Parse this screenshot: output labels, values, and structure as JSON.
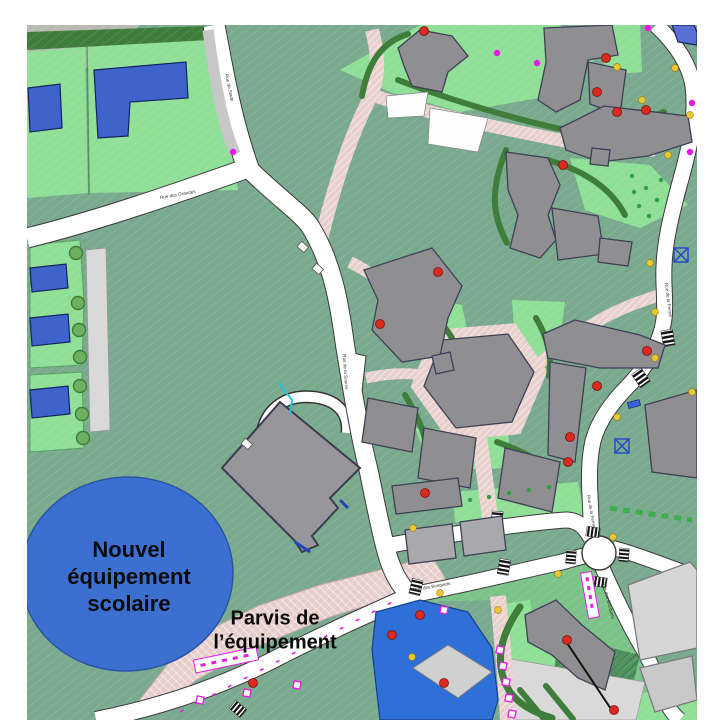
{
  "labels": {
    "school": "Nouvel\néquipement\nscolaire",
    "parvis": "Parvis de\nl’équipement"
  },
  "road_labels": [
    {
      "name": "Rue des Grandes",
      "x": 178,
      "y": 196,
      "rot": -10
    },
    {
      "name": "Rue du Stade",
      "x": 228,
      "y": 88,
      "rot": 78
    },
    {
      "name": "Rue de la Source",
      "x": 344,
      "y": 372,
      "rot": 86
    },
    {
      "name": "Rue des Bosquets",
      "x": 432,
      "y": 588,
      "rot": -10
    },
    {
      "name": "Rue de la Ferme",
      "x": 667,
      "y": 300,
      "rot": 83
    },
    {
      "name": "Rue de la Ferme",
      "x": 590,
      "y": 512,
      "rot": 80
    },
    {
      "name": "Rue des Bosquets",
      "x": 607,
      "y": 601,
      "rot": 75
    }
  ],
  "palette": {
    "field_teal": "#7aaa8e",
    "lawn_green": "#8fdf97",
    "mid_green": "#7cc389",
    "hedge_green": "#3f7d3b",
    "building_gray": "#8f8f92",
    "existing_gray": "#d6d6d6",
    "path_pink": "#e8d0cc",
    "parvis_pink": "#e6cdc9",
    "school_ellipse_blue": "#3b6fd0",
    "house_blue": "#3e63cb",
    "pond_blue": "#2e6fd8",
    "dot_red": "#d92b20",
    "dot_yellow": "#e9c832",
    "dot_magenta": "#e61ae6",
    "tree_green": "#6db060"
  },
  "markers": {
    "red_dots": [
      [
        424,
        31
      ],
      [
        606,
        58
      ],
      [
        597,
        92
      ],
      [
        617,
        112
      ],
      [
        646,
        110
      ],
      [
        563,
        165
      ],
      [
        438,
        272
      ],
      [
        380,
        324
      ],
      [
        647,
        351
      ],
      [
        597,
        386
      ],
      [
        570,
        437
      ],
      [
        568,
        462
      ],
      [
        425,
        493
      ],
      [
        420,
        615
      ],
      [
        392,
        635
      ],
      [
        567,
        640
      ],
      [
        614,
        710
      ],
      [
        253,
        683
      ],
      [
        444,
        683
      ]
    ],
    "yellow_dots": [
      [
        617,
        67
      ],
      [
        675,
        68
      ],
      [
        642,
        100
      ],
      [
        690,
        115
      ],
      [
        668,
        155
      ],
      [
        650,
        263
      ],
      [
        655,
        312
      ],
      [
        655,
        358
      ],
      [
        617,
        417
      ],
      [
        692,
        392
      ],
      [
        613,
        537
      ],
      [
        558,
        574
      ],
      [
        413,
        528
      ],
      [
        440,
        593
      ],
      [
        498,
        610
      ],
      [
        412,
        657
      ]
    ],
    "magenta_dots": [
      [
        648,
        28
      ],
      [
        692,
        103
      ],
      [
        690,
        152
      ],
      [
        233,
        152
      ],
      [
        497,
        53
      ],
      [
        537,
        63
      ]
    ],
    "magenta_squares": [
      [
        500,
        650
      ],
      [
        503,
        666
      ],
      [
        506,
        682
      ],
      [
        509,
        698
      ],
      [
        512,
        714
      ],
      [
        200,
        700
      ],
      [
        247,
        693
      ],
      [
        297,
        685
      ],
      [
        444,
        610
      ]
    ],
    "green_dots": [
      [
        632,
        176
      ],
      [
        646,
        188
      ],
      [
        657,
        200
      ],
      [
        639,
        206
      ],
      [
        661,
        180
      ],
      [
        649,
        216
      ],
      [
        634,
        192
      ],
      [
        470,
        500
      ],
      [
        489,
        497
      ],
      [
        509,
        493
      ],
      [
        529,
        490
      ],
      [
        549,
        487
      ]
    ],
    "trees": [
      [
        76,
        253
      ],
      [
        78,
        303
      ],
      [
        79,
        330
      ],
      [
        80,
        357
      ],
      [
        80,
        386
      ],
      [
        82,
        414
      ],
      [
        83,
        438
      ]
    ]
  }
}
